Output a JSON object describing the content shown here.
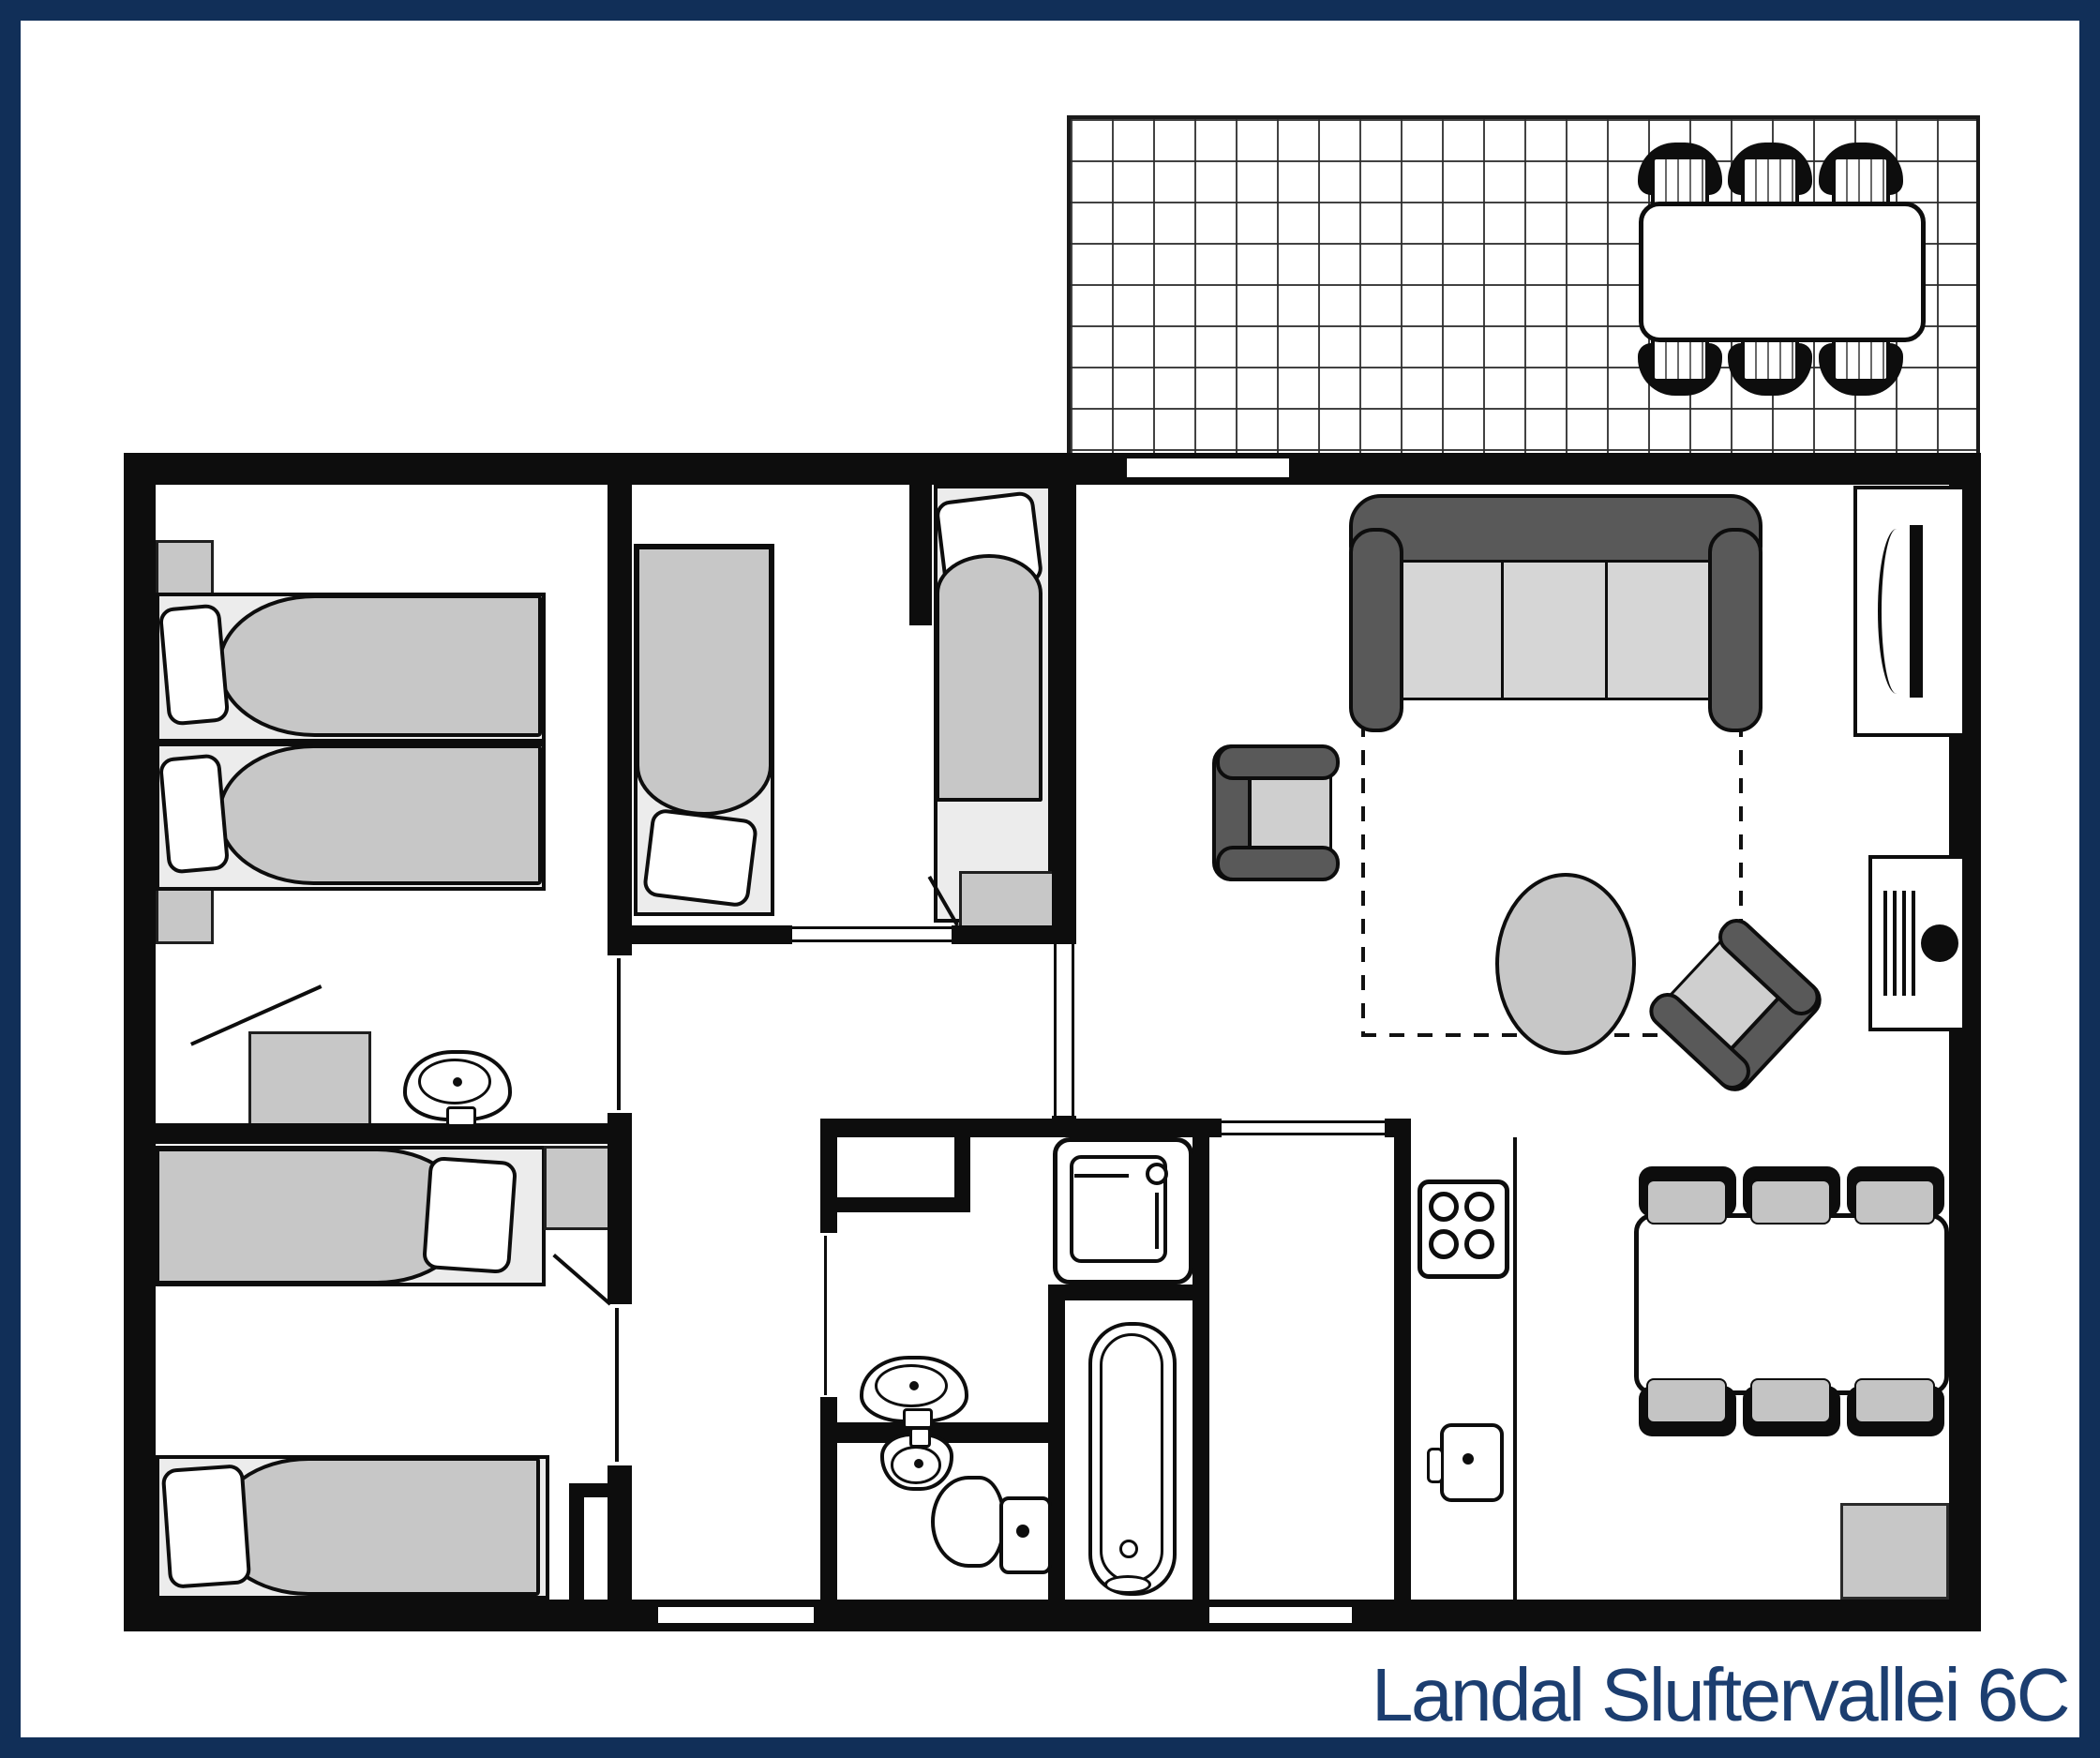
{
  "title": "Landal Sluftervallei 6C",
  "colors": {
    "frame_navy": "#112f58",
    "title_navy": "#1c3e70",
    "wall_black": "#0d0d0d",
    "furniture_gray": "#c7c7c7",
    "bed_base_gray": "#ececec",
    "upholstery_dark_gray": "#595959",
    "cushion_gray": "#d6d6d6"
  },
  "floorplan": {
    "type": "holiday-home plan, top-down view",
    "rooms": [
      {
        "name": "terrace",
        "furniture": [
          "outdoor-dining-table",
          "6 outdoor-chairs",
          "tile-grid-floor"
        ]
      },
      {
        "name": "bedroom-top-left",
        "furniture": [
          "single-bed",
          "single-bed",
          "nightstand",
          "nightstand",
          "washbasin",
          "cabinet-with-open-door"
        ]
      },
      {
        "name": "bedroom-middle",
        "furniture": [
          "single-bed"
        ]
      },
      {
        "name": "bedroom-middle-small",
        "furniture": [
          "single-bed",
          "foot-chest"
        ]
      },
      {
        "name": "bedroom-bottom-left",
        "furniture": [
          "single-bed",
          "single-bed",
          "nightstand",
          "closet-duct"
        ]
      },
      {
        "name": "hall",
        "furniture": []
      },
      {
        "name": "storage-niche",
        "furniture": []
      },
      {
        "name": "bathroom",
        "furniture": [
          "washbasin",
          "shower-cabin",
          "bathtub"
        ]
      },
      {
        "name": "toilet-room",
        "furniture": [
          "washbasin",
          "toilet"
        ]
      },
      {
        "name": "kitchen",
        "furniture": [
          "stove-4-burners",
          "kitchen-sink",
          "counter"
        ]
      },
      {
        "name": "living-dining",
        "furniture": [
          "3-seat-sofa",
          "armchair",
          "rotated-armchair",
          "round-coffee-table",
          "rug-dashed-outline",
          "tv-cabinet",
          "stove-fireplace",
          "dining-table",
          "6 dining-chairs",
          "corner-cupboard"
        ]
      }
    ]
  }
}
